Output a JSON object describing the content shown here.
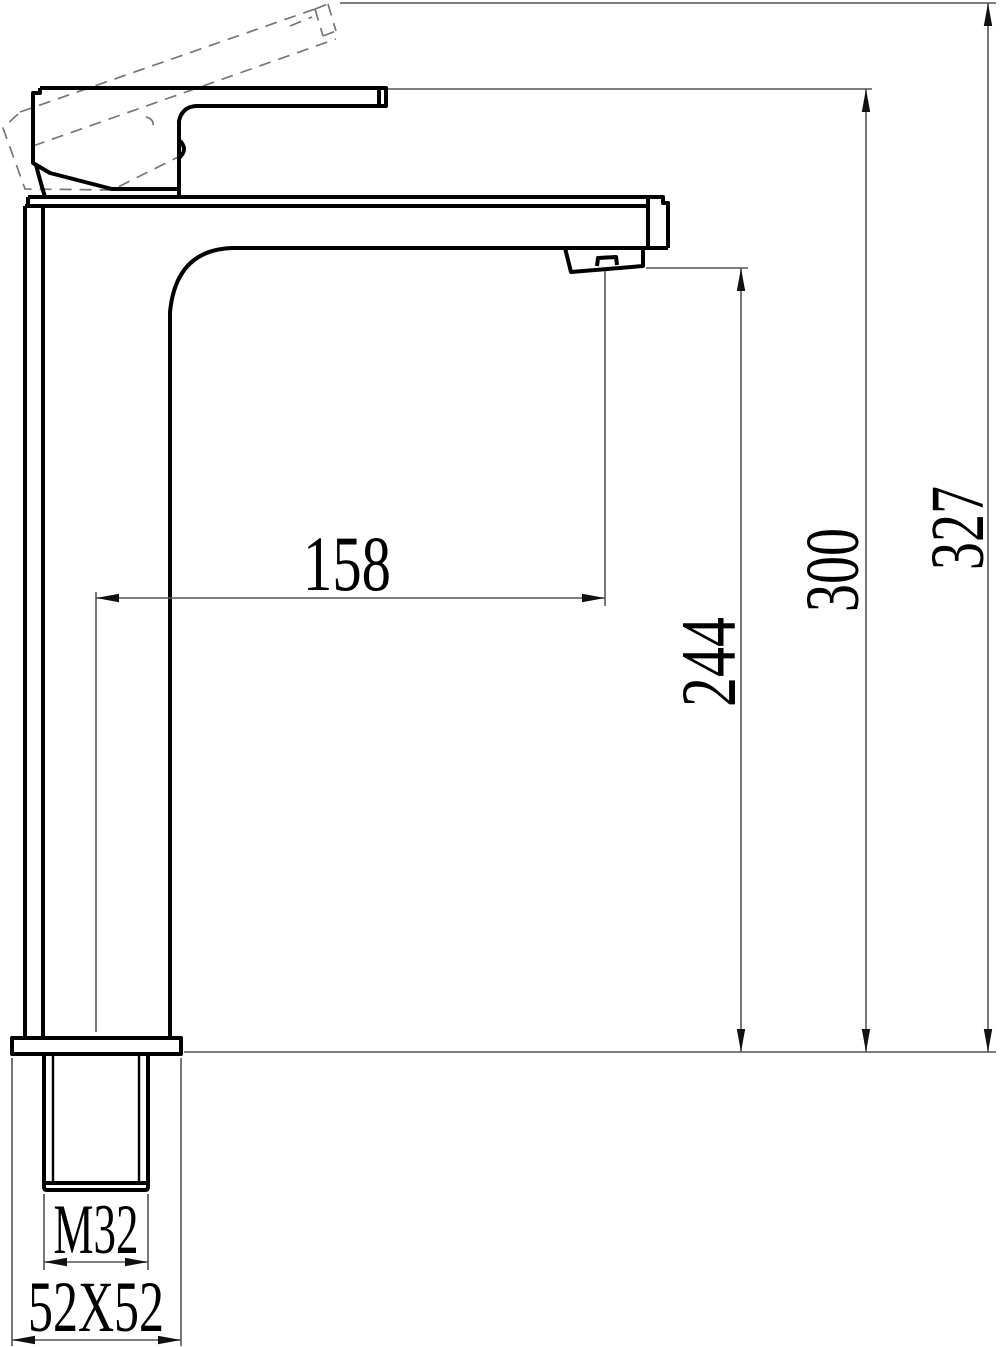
{
  "drawing": {
    "subject": "tall-basin-faucet-side-view",
    "background_color": "#ffffff",
    "line_color": "#000000",
    "dim_line_color": "#555555",
    "phantom_line_color": "#777777",
    "labels": {
      "spout_reach": "158",
      "spout_outlet_height": "244",
      "handle_top_height": "300",
      "overall_height_lever_raised": "327",
      "inlet_thread": "M32",
      "base_section": "52X52"
    }
  }
}
